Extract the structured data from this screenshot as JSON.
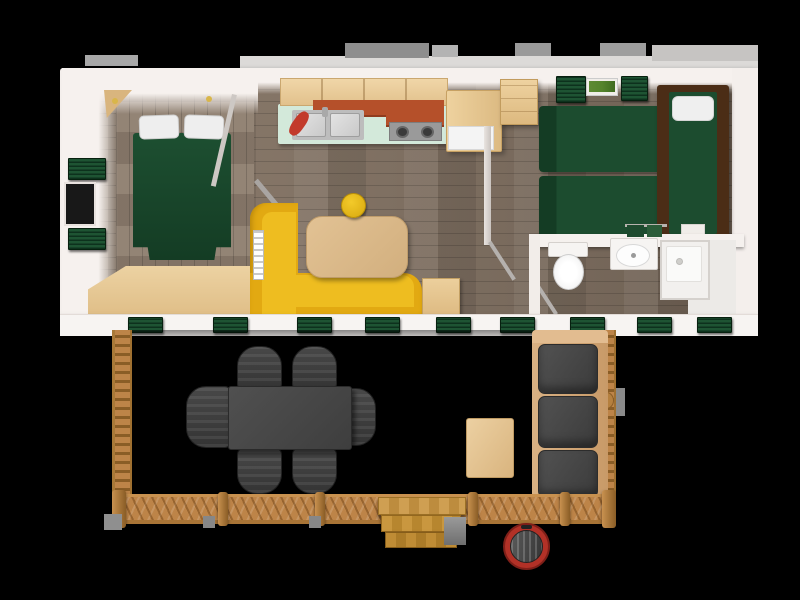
{
  "meta": {
    "description": "Top-down 3D rendering of a mobile home floor plan with a front wooden deck terrace",
    "canvas": {
      "width": 800,
      "height": 600
    }
  },
  "colors": {
    "canvas_bg": "#000000",
    "wall_white": "#f4efec",
    "wall_shadow": "#d8d1cd",
    "floor_wood": "#8d7d6e",
    "floor_wood_dark": "#6f6154",
    "bed_green": "#1c4c2f",
    "bed_green_dark": "#143c24",
    "pillow_white": "#eeeeee",
    "shutter_green": "#1e5433",
    "shutter_green_dark": "#0d311d",
    "cabinet_wood": "#ecd0a0",
    "cabinet_terracotta": "#b5502a",
    "counter_mint": "#d3e9da",
    "sink_steel": "#c6c6c6",
    "bench_yellow": "#e2a912",
    "bench_yellow_light": "#eebd20",
    "bench_yellow_dark": "#b8860b",
    "table_wood": "#dcba8b",
    "stool_yellow": "#eec11d",
    "dark_bed_frame": "#4b2d16",
    "wardrobe_wood": "#e9cd9b",
    "deck_floor": "#968a79",
    "deck_floor_dark": "#6e6354",
    "railing_wood": "#bd8448",
    "railing_wood_dark": "#8a5d26",
    "outdoor_gray": "#454545",
    "sofa_frame_wood": "#d9b183",
    "coffee_table_wood": "#e3c294",
    "steps_wood": "#c9973f",
    "bbq_red": "#b23127",
    "bbq_lid": "#474747",
    "concrete_gray": "#8f8f8f",
    "roof_gray": "#9a9a9a",
    "roof_light": "#dcdad8",
    "ceiling_light": "#d9b64a",
    "planter_green": "#55842c",
    "white_fixture": "#f6f4f2"
  },
  "scene": {
    "building": {
      "type": "mobile-home",
      "rooms": [
        {
          "id": "master-bedroom",
          "furniture": [
            "double-bed",
            "pillow",
            "pillow",
            "corner-shelf",
            "storage-bench",
            "window-shutters"
          ]
        },
        {
          "id": "kitchen",
          "furniture": [
            "upper-cabinets",
            "double-sink",
            "two-burner-stove",
            "fridge-cabinet",
            "red-pan"
          ]
        },
        {
          "id": "living-area",
          "furniture": [
            "l-shaped-yellow-bench",
            "dining-table",
            "round-stool",
            "side-cabinet"
          ]
        },
        {
          "id": "kids-bedroom",
          "furniture": [
            "single-bed",
            "single-bed",
            "single-bed-dark-frame",
            "wardrobe",
            "window-planter"
          ]
        },
        {
          "id": "bathroom",
          "furniture": [
            "toilet",
            "vanity-sink",
            "shower",
            "towel-rail"
          ]
        }
      ],
      "front_window_shutter_count": 9
    },
    "deck": {
      "type": "wooden-terrace",
      "furniture": [
        "outdoor-dining-table",
        "deck-chairs",
        "outdoor-sofa",
        "sofa-cushions",
        "coffee-table",
        "entry-steps",
        "barbecue-grill"
      ],
      "deck_chair_count": 6,
      "sofa_cushion_count": 3
    }
  }
}
